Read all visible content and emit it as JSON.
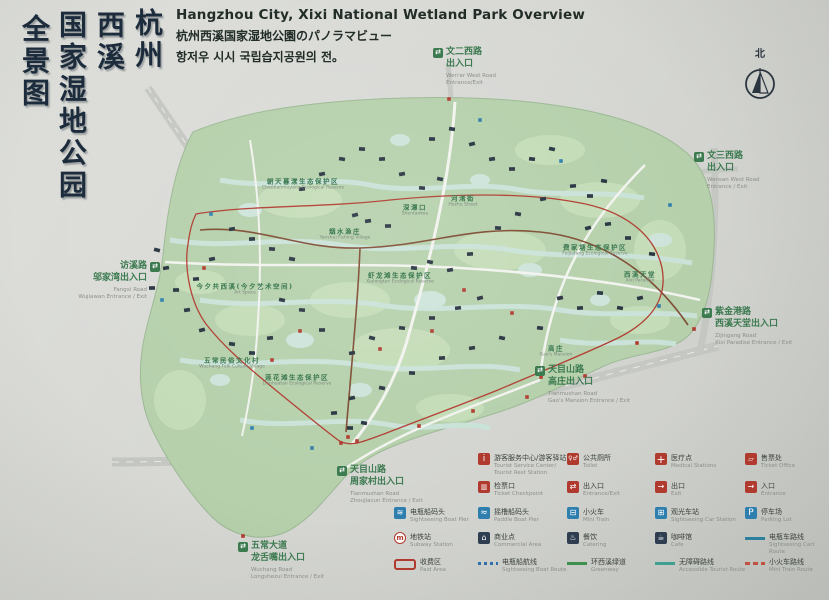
{
  "header": {
    "title_en": "Hangzhou City, Xixi National Wetland Park Overview",
    "title_ja": "杭州西溪国家湿地公園のパノラマビュー",
    "title_ko": "항저우 시시 국립습지공원의 전。"
  },
  "vertical_title": {
    "columns": [
      "杭州",
      "西溪",
      "国家湿地公园",
      "全景图"
    ]
  },
  "compass": {
    "label": "北",
    "icon": "north-arrow-icon"
  },
  "entrances": [
    {
      "x": 433,
      "y": 48,
      "align": "left",
      "zh": [
        "文二西路",
        "出入口"
      ],
      "en": [
        "Wen'er West Road",
        "Entrance/Exit"
      ]
    },
    {
      "x": 694,
      "y": 152,
      "align": "left",
      "zh": [
        "文三西路",
        "出入口"
      ],
      "en": [
        "Wensan West Road",
        "Entrance / Exit"
      ]
    },
    {
      "x": 702,
      "y": 308,
      "align": "left",
      "zh": [
        "紫金港路",
        "西溪天堂出入口"
      ],
      "en": [
        "Zijingang Road",
        "Xixi Paradise Entrance / Exit"
      ]
    },
    {
      "x": 535,
      "y": 366,
      "align": "left",
      "zh": [
        "天目山路",
        "高庄出入口"
      ],
      "en": [
        "Tianmushan Road",
        "Gao's Mansion Entrance / Exit"
      ]
    },
    {
      "x": 337,
      "y": 466,
      "align": "left",
      "zh": [
        "天目山路",
        "周家村出入口"
      ],
      "en": [
        "Tianmushan Road",
        "Zhoujiacun Entrance / Exit"
      ]
    },
    {
      "x": 238,
      "y": 542,
      "align": "left",
      "zh": [
        "五常大道",
        "龙舌嘴出入口"
      ],
      "en": [
        "Wuchang Road",
        "Longshezui Entrance / Exit"
      ]
    },
    {
      "x": 160,
      "y": 262,
      "align": "right",
      "zh": [
        "访溪路",
        "邬家湾出入口"
      ],
      "en": [
        "Fangxi Road",
        "Wujiawan Entrance / Exit"
      ]
    }
  ],
  "legend": {
    "rows": [
      {
        "y": 453,
        "items": [
          {
            "col": 1,
            "zh": "游客服务中心/游客驿站",
            "en": "Tourist Service Center/\nTourist Rest Station",
            "icon_name": "tourist-service-icon",
            "icon": {
              "type": "sq",
              "bg": "#b03a2e",
              "glyph": "i",
              "fs": 9
            }
          },
          {
            "col": 2,
            "zh": "公共厕所",
            "en": "Toilet",
            "icon_name": "toilet-icon",
            "icon": {
              "type": "sq",
              "bg": "#b03a2e",
              "glyph": "♀♂",
              "fs": 6
            }
          },
          {
            "col": 3,
            "zh": "医疗点",
            "en": "Medical Stations",
            "icon_name": "medical-icon",
            "icon": {
              "type": "sq",
              "bg": "#b03a2e",
              "glyph": "+",
              "fs": 11
            }
          },
          {
            "col": 4,
            "zh": "售票处",
            "en": "Ticket Office",
            "icon_name": "ticket-office-icon",
            "icon": {
              "type": "sq",
              "bg": "#b03a2e",
              "glyph": "▱",
              "fs": 7
            }
          }
        ]
      },
      {
        "y": 481,
        "items": [
          {
            "col": 1,
            "zh": "检票口",
            "en": "Ticket Checkpoint",
            "icon_name": "ticket-checkpoint-icon",
            "icon": {
              "type": "sq",
              "bg": "#b03a2e",
              "glyph": "▥",
              "fs": 7
            }
          },
          {
            "col": 2,
            "zh": "出入口",
            "en": "Entrance/Exit",
            "icon_name": "entrance-exit-icon",
            "icon": {
              "type": "sq",
              "bg": "#b03a2e",
              "glyph": "⇄",
              "fs": 8
            }
          },
          {
            "col": 3,
            "zh": "出口",
            "en": "Exit",
            "icon_name": "exit-icon",
            "icon": {
              "type": "sq",
              "bg": "#b03a2e",
              "glyph": "→",
              "fs": 8
            }
          },
          {
            "col": 4,
            "zh": "入口",
            "en": "Entrance",
            "icon_name": "entrance-icon",
            "icon": {
              "type": "sq",
              "bg": "#b03a2e",
              "glyph": "→",
              "fs": 8
            }
          }
        ]
      },
      {
        "y": 507,
        "items": [
          {
            "col": 0,
            "zh": "电瓶船码头",
            "en": "Sightseeing Boat Pier",
            "icon_name": "sightseeing-boat-pier-icon",
            "icon": {
              "type": "sq",
              "bg": "#2e7fae",
              "glyph": "≋",
              "fs": 8
            }
          },
          {
            "col": 1,
            "zh": "摇橹船码头",
            "en": "Paddle Boat Pier",
            "icon_name": "paddle-boat-pier-icon",
            "icon": {
              "type": "sq",
              "bg": "#2e7fae",
              "glyph": "≈",
              "fs": 9
            }
          },
          {
            "col": 2,
            "zh": "小火车",
            "en": "Mini Train",
            "icon_name": "mini-train-icon",
            "icon": {
              "type": "sq",
              "bg": "#2e7fae",
              "glyph": "⊟",
              "fs": 8
            }
          },
          {
            "col": 3,
            "zh": "观光车站",
            "en": "Sightseeing Car Station",
            "icon_name": "sightseeing-car-icon",
            "icon": {
              "type": "sq",
              "bg": "#2e7fae",
              "glyph": "⊞",
              "fs": 8
            }
          },
          {
            "col": 4,
            "zh": "停车场",
            "en": "Parking Lot",
            "icon_name": "parking-icon",
            "icon": {
              "type": "sq",
              "bg": "#2e7fae",
              "glyph": "P",
              "fs": 9
            }
          }
        ]
      },
      {
        "y": 532,
        "items": [
          {
            "col": 0,
            "zh": "地铁站",
            "en": "Subway Station",
            "icon_name": "subway-icon",
            "icon": {
              "type": "circle",
              "glyph": "m"
            }
          },
          {
            "col": 1,
            "zh": "商业点",
            "en": "Commercial Area",
            "icon_name": "commercial-icon",
            "icon": {
              "type": "sq",
              "bg": "#2e3d4f",
              "glyph": "⌂",
              "fs": 8
            }
          },
          {
            "col": 2,
            "zh": "餐饮",
            "en": "Catering",
            "icon_name": "catering-icon",
            "icon": {
              "type": "sq",
              "bg": "#2e3d4f",
              "glyph": "♨",
              "fs": 8
            }
          },
          {
            "col": 3,
            "zh": "咖啡馆",
            "en": "Cafe",
            "icon_name": "cafe-icon",
            "icon": {
              "type": "sq",
              "bg": "#2e3d4f",
              "glyph": "☕",
              "fs": 8
            }
          },
          {
            "col": 4,
            "zh": "电瓶车路线",
            "en": "Sightseeing Cart Route",
            "icon_name": "cart-route-line",
            "icon": {
              "type": "line",
              "style": "solid",
              "color": "#2d7f9e"
            }
          }
        ]
      },
      {
        "y": 557,
        "items": [
          {
            "col": 0,
            "zh": "收费区",
            "en": "Paid Area",
            "icon_name": "paid-area-symbol",
            "icon": {
              "type": "rect"
            }
          },
          {
            "col": 1,
            "zh": "电瓶船航线",
            "en": "Sightseeing Boat Route",
            "icon_name": "boat-route-line",
            "icon": {
              "type": "line",
              "style": "dotted",
              "color": "#2e6fae"
            }
          },
          {
            "col": 2,
            "zh": "环西溪绿道",
            "en": "Greenway",
            "icon_name": "greenway-line",
            "icon": {
              "type": "line",
              "style": "solid",
              "color": "#3f8f4f"
            }
          },
          {
            "col": 3,
            "zh": "无障碍路线",
            "en": "Accessible Tourist Route",
            "icon_name": "accessible-route-line",
            "icon": {
              "type": "line",
              "style": "solid",
              "color": "#3fa08f"
            }
          },
          {
            "col": 4,
            "zh": "小火车路线",
            "en": "Mini Train Route",
            "icon_name": "mini-train-route-line",
            "icon": {
              "type": "line",
              "style": "dashed",
              "color": "#c05040"
            }
          }
        ]
      }
    ]
  },
  "map": {
    "labels": [
      {
        "zh": "朝天暮漾生态保护区",
        "en": "Chaotianmuyang Ecological Reserve",
        "x": 303,
        "y": 183
      },
      {
        "zh": "费家塘生态保护区",
        "en": "Feijiatang Ecological Reserve",
        "x": 595,
        "y": 249
      },
      {
        "zh": "虾龙滩生态保护区",
        "en": "Xialongtan Ecological Reserve",
        "x": 400,
        "y": 277
      },
      {
        "zh": "莲花滩生态保护区",
        "en": "Lianhuatan Ecological Reserve",
        "x": 297,
        "y": 379
      },
      {
        "zh": "西溪天堂",
        "en": "Xixi Paradise",
        "x": 640,
        "y": 276
      },
      {
        "zh": "烟水渔庄",
        "en": "Yanshui Fishing Village",
        "x": 345,
        "y": 233
      },
      {
        "zh": "河渚街",
        "en": "Hezhu Street",
        "x": 463,
        "y": 200
      },
      {
        "zh": "深潭口",
        "en": "Shentankou",
        "x": 415,
        "y": 209
      },
      {
        "zh": "今夕共西溪(今夕艺术空间)",
        "en": "Art Space",
        "x": 245,
        "y": 288
      },
      {
        "zh": "五常民俗文化村",
        "en": "Wuchang Folk Culture Village",
        "x": 232,
        "y": 362
      },
      {
        "zh": "高庄",
        "en": "Gao's Mansion",
        "x": 556,
        "y": 350
      }
    ],
    "building_marks": [
      [
        355,
        215
      ],
      [
        368,
        221
      ],
      [
        388,
        226
      ],
      [
        414,
        268
      ],
      [
        430,
        262
      ],
      [
        450,
        270
      ],
      [
        470,
        254
      ],
      [
        498,
        228
      ],
      [
        518,
        214
      ],
      [
        543,
        199
      ],
      [
        573,
        186
      ],
      [
        590,
        196
      ],
      [
        604,
        181
      ],
      [
        480,
        298
      ],
      [
        458,
        308
      ],
      [
        432,
        318
      ],
      [
        402,
        328
      ],
      [
        372,
        338
      ],
      [
        352,
        353
      ],
      [
        322,
        330
      ],
      [
        302,
        310
      ],
      [
        282,
        300
      ],
      [
        560,
        298
      ],
      [
        580,
        308
      ],
      [
        600,
        293
      ],
      [
        620,
        308
      ],
      [
        640,
        298
      ],
      [
        270,
        338
      ],
      [
        252,
        353
      ],
      [
        232,
        344
      ],
      [
        202,
        330
      ],
      [
        187,
        310
      ],
      [
        176,
        290
      ],
      [
        540,
        328
      ],
      [
        502,
        338
      ],
      [
        472,
        348
      ],
      [
        442,
        358
      ],
      [
        412,
        373
      ],
      [
        382,
        388
      ],
      [
        352,
        398
      ],
      [
        334,
        413
      ],
      [
        350,
        428
      ],
      [
        364,
        423
      ],
      [
        588,
        228
      ],
      [
        608,
        224
      ],
      [
        628,
        238
      ],
      [
        652,
        254
      ],
      [
        157,
        250
      ],
      [
        166,
        268
      ],
      [
        152,
        288
      ],
      [
        422,
        188
      ],
      [
        440,
        179
      ],
      [
        402,
        174
      ],
      [
        382,
        159
      ],
      [
        362,
        149
      ],
      [
        342,
        159
      ],
      [
        322,
        174
      ],
      [
        302,
        189
      ],
      [
        432,
        139
      ],
      [
        452,
        129
      ],
      [
        472,
        144
      ],
      [
        492,
        159
      ],
      [
        512,
        169
      ],
      [
        532,
        159
      ],
      [
        552,
        149
      ],
      [
        232,
        229
      ],
      [
        252,
        239
      ],
      [
        272,
        249
      ],
      [
        292,
        259
      ],
      [
        212,
        259
      ],
      [
        196,
        279
      ]
    ],
    "red_marks": [
      [
        348,
        437
      ],
      [
        357,
        441
      ],
      [
        341,
        443
      ],
      [
        541,
        377
      ],
      [
        637,
        343
      ],
      [
        449,
        99
      ],
      [
        204,
        268
      ],
      [
        243,
        536
      ],
      [
        694,
        329
      ],
      [
        419,
        426
      ],
      [
        473,
        411
      ],
      [
        527,
        397
      ],
      [
        585,
        376
      ],
      [
        464,
        290
      ],
      [
        512,
        313
      ],
      [
        300,
        331
      ],
      [
        272,
        360
      ],
      [
        432,
        331
      ],
      [
        380,
        349
      ]
    ],
    "blue_marks": [
      [
        211,
        214
      ],
      [
        561,
        161
      ],
      [
        659,
        306
      ],
      [
        252,
        428
      ],
      [
        312,
        448
      ],
      [
        480,
        120
      ],
      [
        670,
        205
      ],
      [
        162,
        300
      ]
    ]
  }
}
